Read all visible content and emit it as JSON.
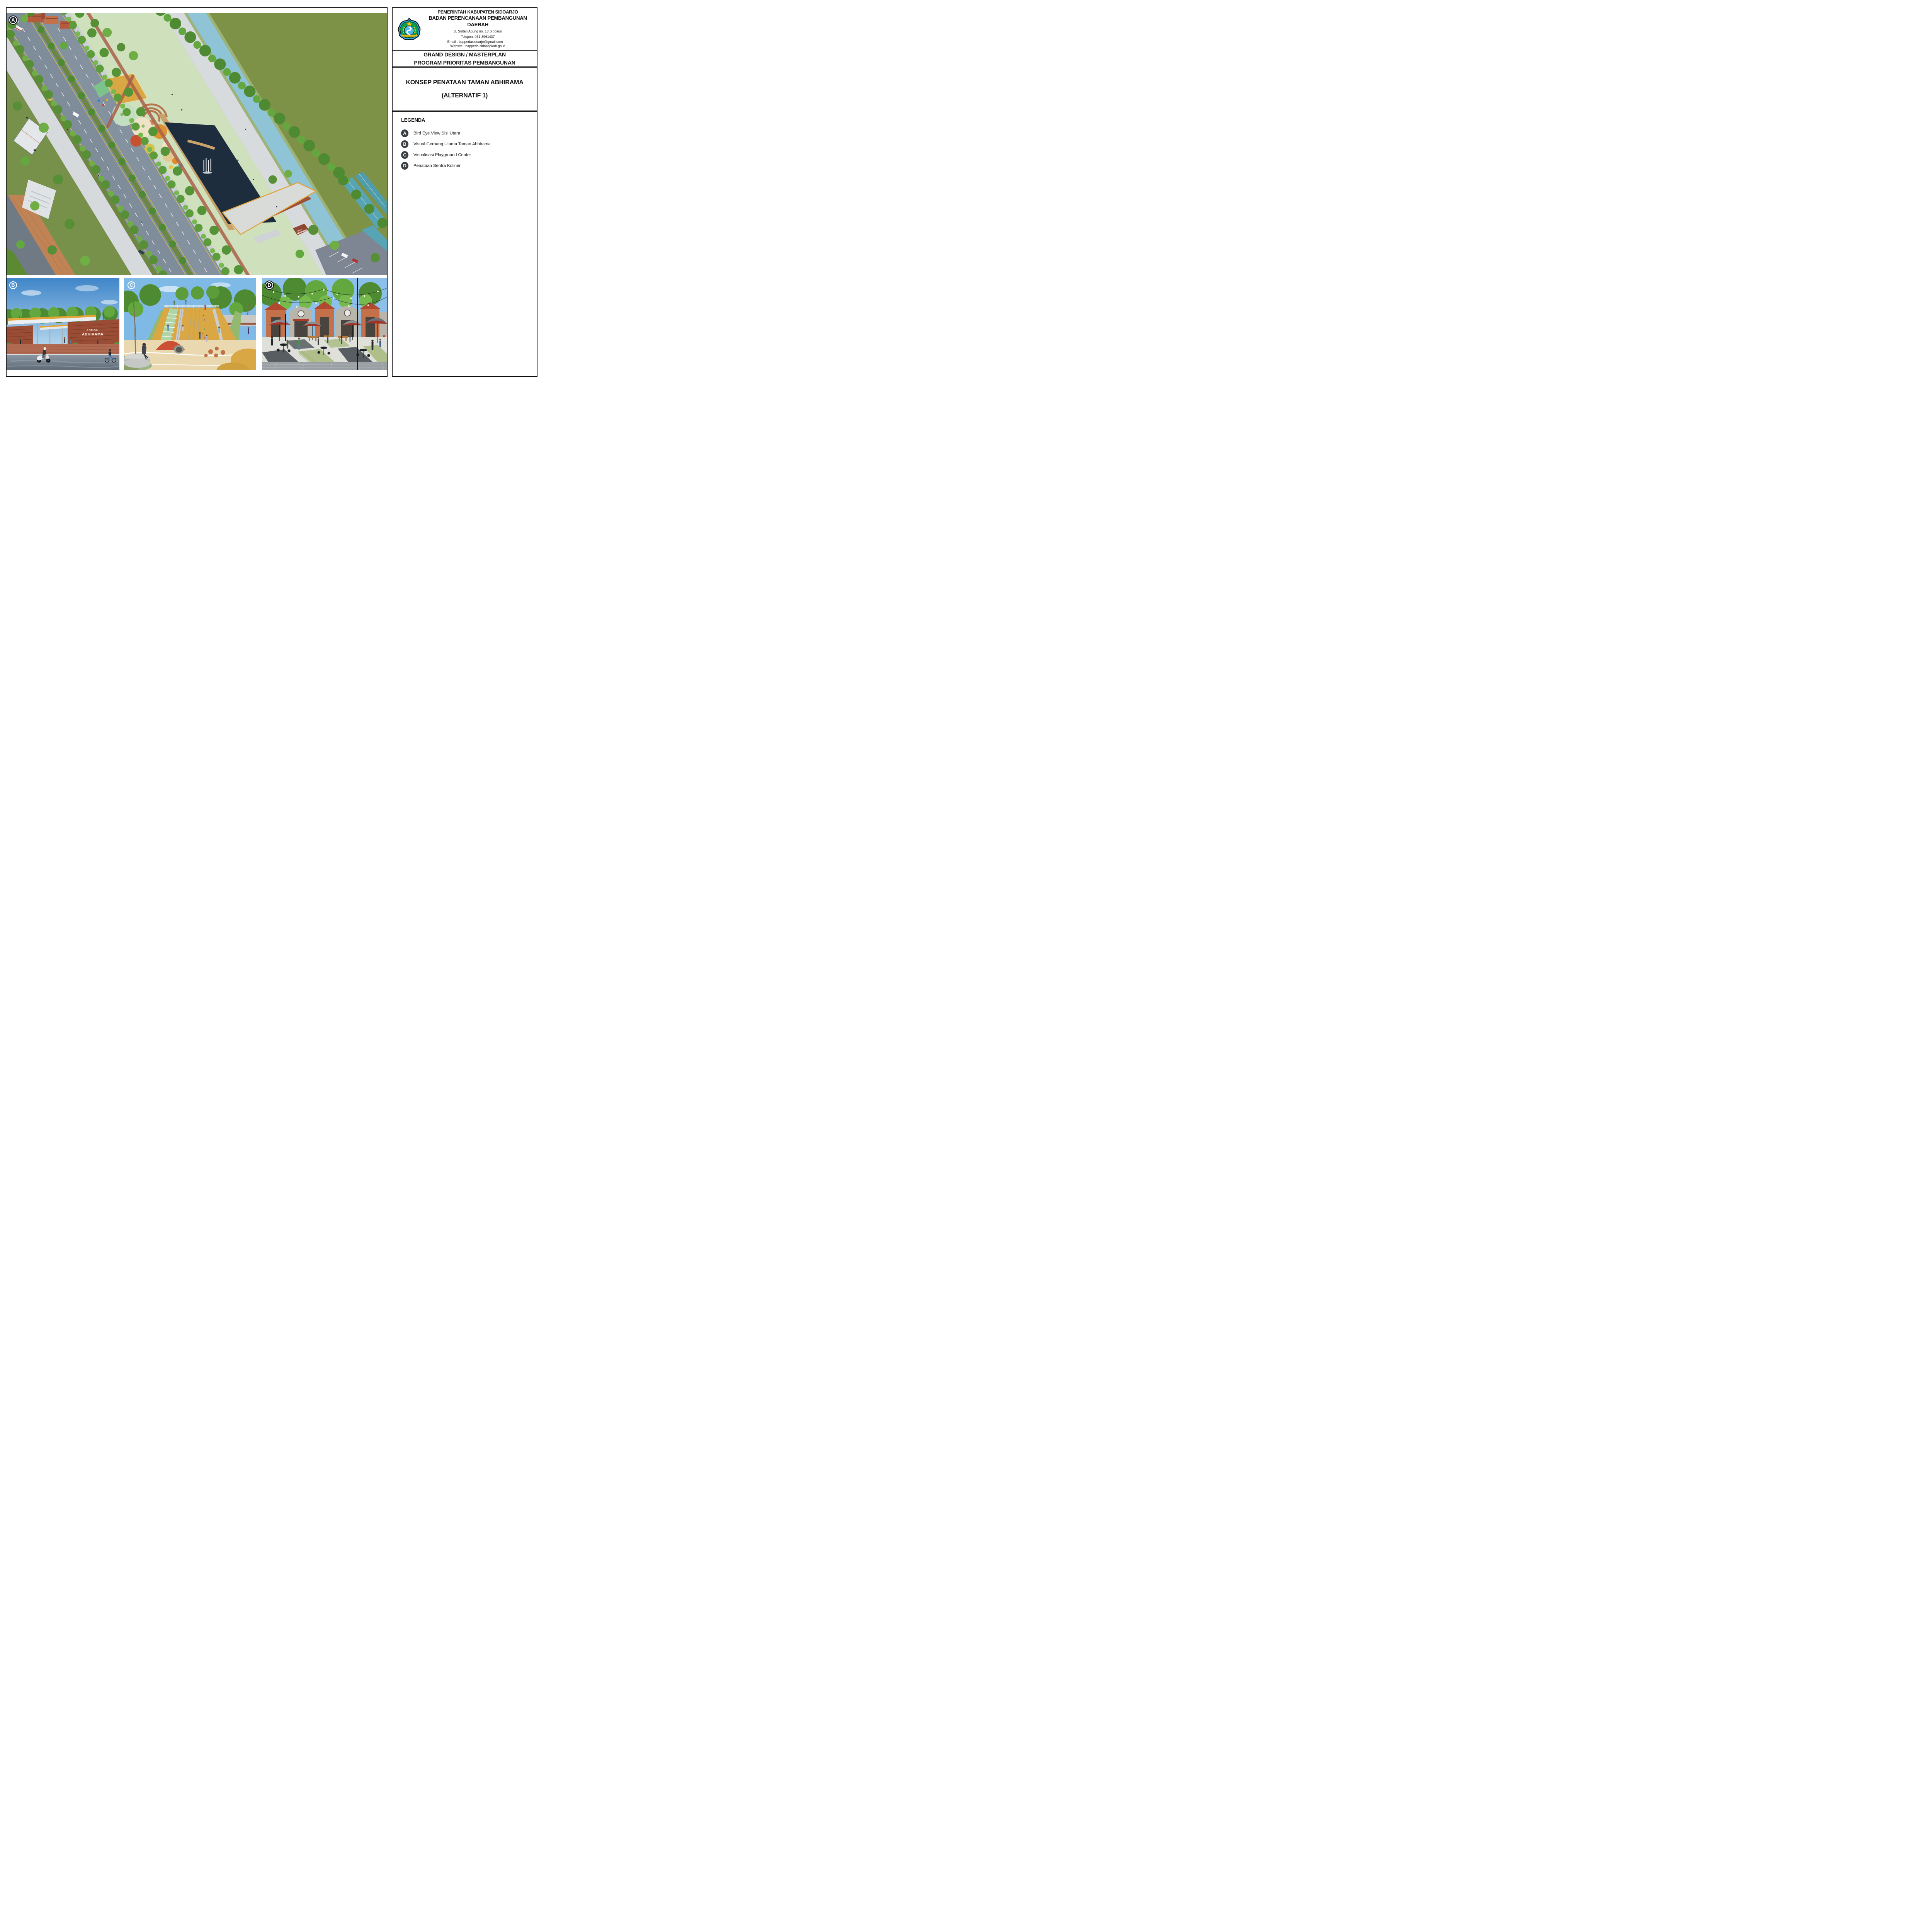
{
  "document": {
    "sheet_bg": "#ffffff",
    "frame_color": "#0e0e0e"
  },
  "panel": {
    "header": {
      "agency_line1": "PEMERINTAH KABUPATEN SIDOARJO",
      "agency_line2": "BADAN PERENCANAAN PEMBANGUNAN DAERAH",
      "address_line": "Jl. Sultan Agung no. 13 Sidoarjo",
      "phone_line": "Telepon. 031-8961437",
      "email_label": "Email : bappedasidoarjo@gmail.com",
      "website_label": "Website : bappeda.sidoarjokab.go.id",
      "logo": {
        "name": "lambang-kabupaten-sidoarjo",
        "banner_text": "KABUPATEN SIDOARJO",
        "colors": {
          "border_blue": "#29abe2",
          "field_green": "#0aa14b",
          "star_yellow": "#f2c81e",
          "center_blue": "#4db8e8",
          "wreath_yellow": "#e8c51d",
          "shrimp_white": "#ffffff"
        }
      }
    },
    "title_block": {
      "line1": "GRAND DESIGN / MASTERPLAN",
      "line2": "PROGRAM PRIORITAS PEMBANGUNAN"
    },
    "concept_block": {
      "line1": "KONSEP PENATAAN TAMAN ABHIRAMA",
      "line2": "(ALTERNATIF 1)"
    },
    "legend": {
      "heading": "LEGENDA",
      "items": [
        {
          "key": "A",
          "label": "Bird Eye View Sisi Utara"
        },
        {
          "key": "B",
          "label": "Visual Gerbang Utama Taman Abhirama"
        },
        {
          "key": "C",
          "label": "Visualisasi Playground Center"
        },
        {
          "key": "D",
          "label": "Penataan Sentra Kuliner"
        }
      ]
    }
  },
  "views": {
    "a": {
      "label": "A",
      "badge_style": "filled",
      "gate_sign_line1": "TAMAN",
      "gate_sign_line2": "ABHIRAMA"
    },
    "b": {
      "label": "B",
      "badge_style": "outline",
      "gate_sign_line1": "TAMAN",
      "gate_sign_line2": "ABHIRAMA"
    },
    "c": {
      "label": "C",
      "badge_style": "outline"
    },
    "d": {
      "label": "D",
      "badge_style": "filled"
    }
  },
  "palette": {
    "field_green": "#7e9247",
    "tree_green_dark": "#4e8a31",
    "tree_green_mid": "#63a83e",
    "asphalt": "#84919f",
    "promenade_gray": "#d7dadc",
    "pond_dark": "#1e2d3d",
    "canal_blue": "#8fc3d6",
    "brick_red": "#a9604a",
    "canopy_orange": "#e2a435",
    "playground_mustard": "#d9a844",
    "kiosk_terracotta": "#c4714a",
    "badge_dark": "#14191f"
  }
}
